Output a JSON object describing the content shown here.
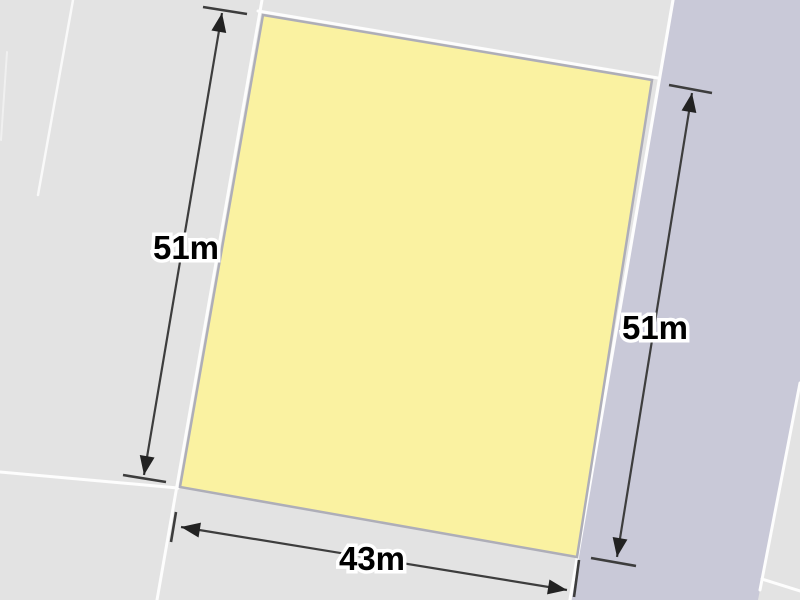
{
  "map": {
    "measurements": {
      "left_side": "51m",
      "right_side": "51m",
      "bottom_side": "43m"
    },
    "colors": {
      "background": "#e3e3e3",
      "road": "#c9c9d8",
      "parcel_fill": "#faf2a1",
      "parcel_border": "#aeaeb8",
      "boundary_line": "#fdfdfd",
      "dimension_line": "#3d3d3d",
      "label_text": "#000000",
      "label_halo": "#ffffff"
    }
  }
}
